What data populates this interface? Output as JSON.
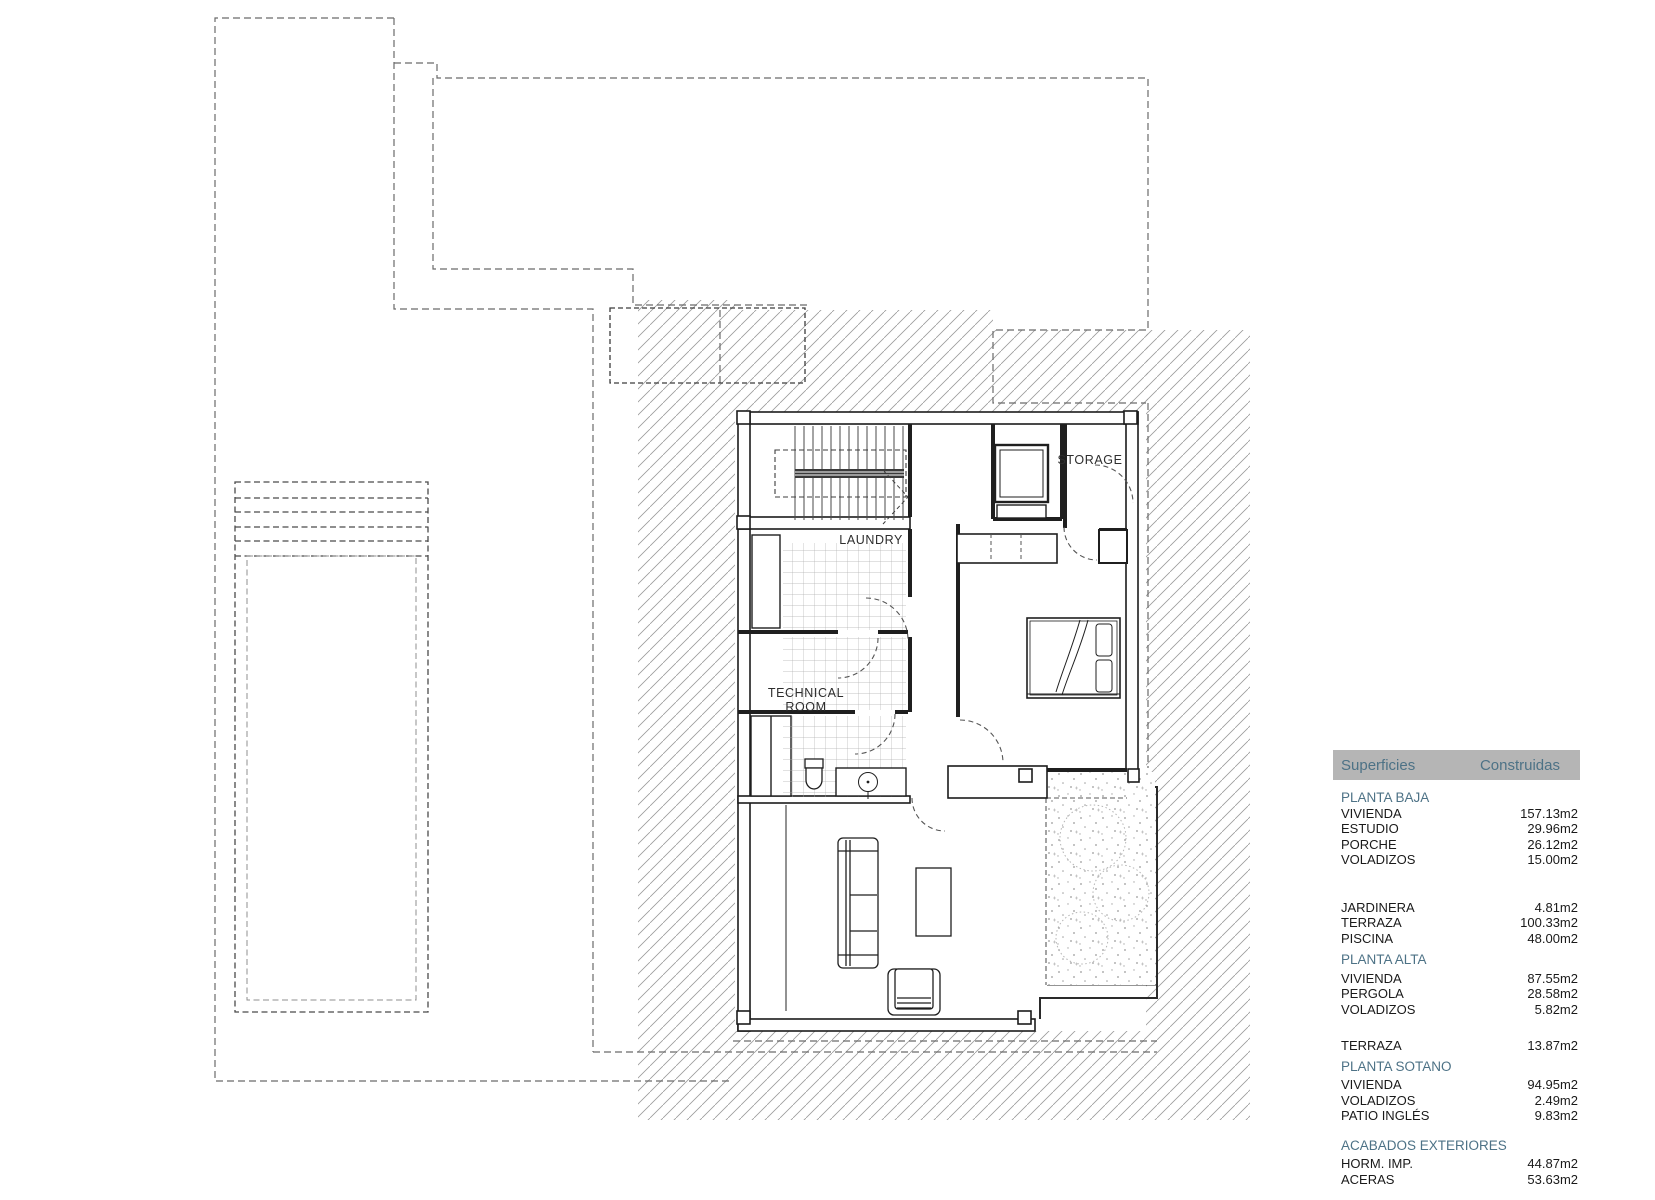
{
  "plan": {
    "labels": {
      "storage": "STORAGE",
      "laundry": "LAUNDRY",
      "technical_line1": "TECHNICAL",
      "technical_line2": "ROOM"
    }
  },
  "table": {
    "header": {
      "col1": "Superficies",
      "col2": "Construidas"
    },
    "colors": {
      "accent": "#4d7286",
      "header_bg": "#b5b5b5",
      "text": "#1a1a1a"
    },
    "sections": [
      {
        "title": "PLANTA BAJA",
        "rows": [
          {
            "label": "VIVIENDA",
            "value": "157.13m2"
          },
          {
            "label": "ESTUDIO",
            "value": "29.96m2"
          },
          {
            "label": "PORCHE",
            "value": "26.12m2"
          },
          {
            "label": "VOLADIZOS",
            "value": "15.00m2"
          }
        ],
        "extra_rows": [
          {
            "label": "JARDINERA",
            "value": "4.81m2"
          },
          {
            "label": "TERRAZA",
            "value": "100.33m2"
          },
          {
            "label": "PISCINA",
            "value": "48.00m2"
          }
        ]
      },
      {
        "title": "PLANTA ALTA",
        "rows": [
          {
            "label": "VIVIENDA",
            "value": "87.55m2"
          },
          {
            "label": "PERGOLA",
            "value": "28.58m2"
          },
          {
            "label": "VOLADIZOS",
            "value": "5.82m2"
          }
        ],
        "extra_rows": [
          {
            "label": "TERRAZA",
            "value": "13.87m2"
          }
        ]
      },
      {
        "title": "PLANTA SOTANO",
        "rows": [
          {
            "label": "VIVIENDA",
            "value": "94.95m2"
          },
          {
            "label": "VOLADIZOS",
            "value": "2.49m2"
          },
          {
            "label": "PATIO INGLÉS",
            "value": "9.83m2"
          }
        ],
        "extra_rows": []
      },
      {
        "title": "ACABADOS EXTERIORES",
        "rows": [
          {
            "label": "HORM. IMP.",
            "value": "44.87m2"
          },
          {
            "label": "ACERAS",
            "value": "53.63m2"
          }
        ],
        "extra_rows": []
      }
    ]
  }
}
